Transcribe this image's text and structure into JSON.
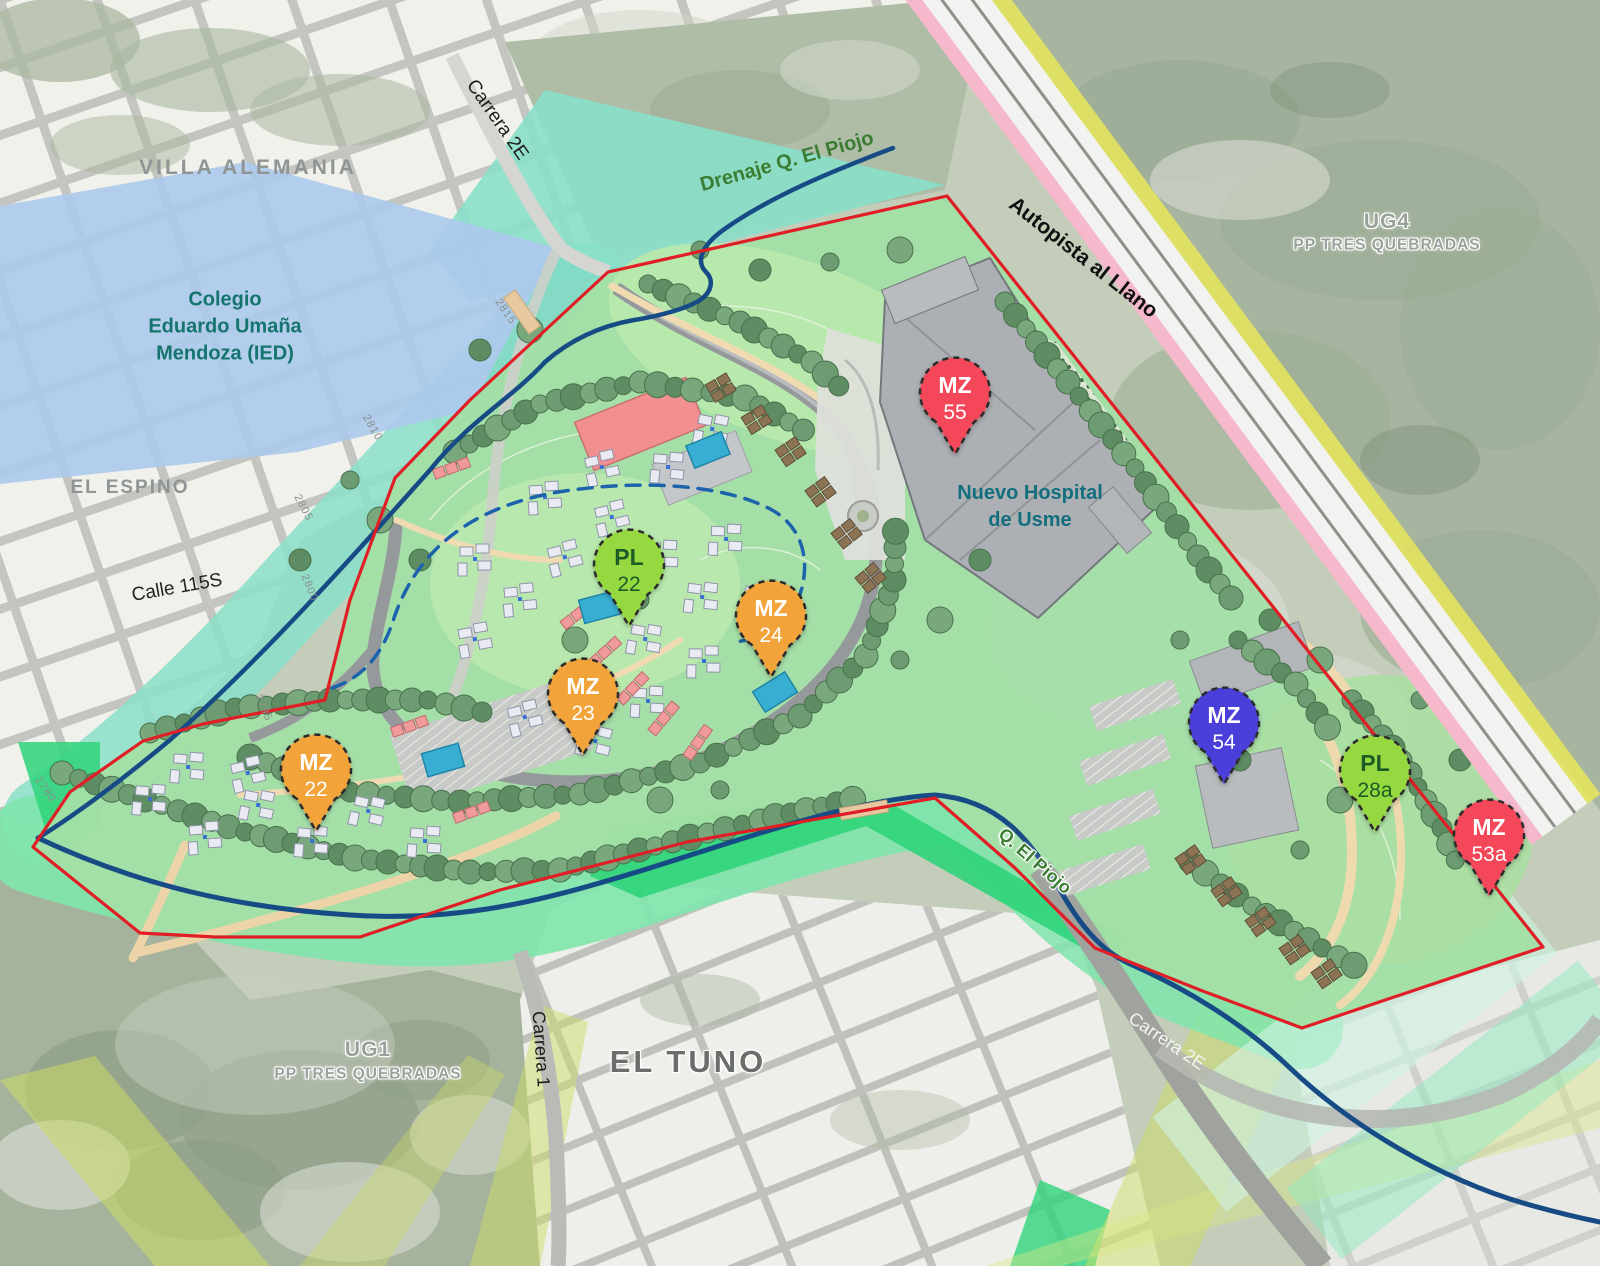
{
  "map": {
    "description": "Urban development site plan, Usme sector",
    "colors": {
      "site_boundary_red": "#E01E25",
      "stream_blue": "#164B85",
      "dashed_drain_blue": "#1C63AC",
      "drainage_overlay_teal": "#8ADFC9",
      "school_overlay_blue": "#ACC9EC",
      "corridor_green": "#7FE5AC",
      "bright_green": "#2FD47A",
      "highway_yellow_stripe": "#E8E85A",
      "highway_pink_stripe": "#F5B9CB",
      "pin_red": "#F4485A",
      "pin_orange": "#F2A43A",
      "pin_green": "#96D83F",
      "pin_indigo": "#4A3FD9"
    },
    "labels": [
      {
        "id": "villa-alemania",
        "text": "VILLA  ALEMANIA",
        "x": 248,
        "y": 168,
        "rot": 0,
        "size": 21,
        "color": "#8E9594",
        "weight": 700,
        "spacing": "3px",
        "halo": false
      },
      {
        "id": "colegio-eduardo-umana",
        "text": "Colegio\nEduardo  Umaña\nMendoza (IED)",
        "x": 225,
        "y": 327,
        "rot": 0,
        "size": 20,
        "color": "#15756E",
        "weight": 700,
        "spacing": "0px",
        "halo": false
      },
      {
        "id": "el-espino",
        "text": "EL ESPINO",
        "x": 130,
        "y": 488,
        "rot": 0,
        "size": 19,
        "color": "#8E9594",
        "weight": 700,
        "spacing": "2px",
        "halo": false
      },
      {
        "id": "calle-115s",
        "text": "Calle 115S",
        "x": 177,
        "y": 588,
        "rot": -10,
        "size": 19,
        "color": "#222222",
        "weight": 400,
        "spacing": "0px",
        "halo": false
      },
      {
        "id": "carrera-2e-top",
        "text": "Carrera 2E",
        "x": 497,
        "y": 120,
        "rot": 55,
        "size": 19,
        "color": "#1b1b1b",
        "weight": 400,
        "spacing": "0px",
        "halo": false
      },
      {
        "id": "drenaje-q-el-piojo",
        "text": "Drenaje Q. El Piojo",
        "x": 787,
        "y": 162,
        "rot": -15.5,
        "size": 20,
        "color": "#3A7D33",
        "weight": 700,
        "spacing": "0px",
        "halo": false
      },
      {
        "id": "autopista-al-llano",
        "text": "Autopista al Llano",
        "x": 1083,
        "y": 258,
        "rot": 38,
        "size": 21,
        "color": "#101010",
        "weight": 700,
        "spacing": "0px",
        "halo": false
      },
      {
        "id": "ug4",
        "text": "UG4",
        "x": 1387,
        "y": 222,
        "rot": 0,
        "size": 21,
        "color": "#98A29A",
        "weight": 700,
        "spacing": "1px",
        "halo": true
      },
      {
        "id": "ug4-pp-tres-quebradas",
        "text": "PP TRES QUEBRADAS",
        "x": 1387,
        "y": 246,
        "rot": 0,
        "size": 15.5,
        "color": "#98A29A",
        "weight": 700,
        "spacing": "1px",
        "halo": true
      },
      {
        "id": "nuevo-hospital-de-usme",
        "text": "Nuevo Hospital\nde Usme",
        "x": 1030,
        "y": 507,
        "rot": 0,
        "size": 20,
        "color": "#136F7E",
        "weight": 700,
        "spacing": "0px",
        "halo": false
      },
      {
        "id": "q-el-piojo",
        "text": "Q. El Piojo",
        "x": 1035,
        "y": 861,
        "rot": 41,
        "size": 18,
        "color": "#3A7D33",
        "weight": 700,
        "spacing": "0px",
        "halo": true
      },
      {
        "id": "carrera-2e-bottom",
        "text": "Carrera 2E",
        "x": 1167,
        "y": 1041,
        "rot": 34,
        "size": 18,
        "color": "#F4F4F2",
        "weight": 400,
        "spacing": "0px",
        "halo": false
      },
      {
        "id": "carrera-1",
        "text": "Carrera 1",
        "x": 541,
        "y": 1049,
        "rot": 86,
        "size": 18,
        "color": "#1b1b1b",
        "weight": 400,
        "spacing": "0px",
        "halo": false
      },
      {
        "id": "ug1",
        "text": "UG1",
        "x": 368,
        "y": 1050,
        "rot": 0,
        "size": 21,
        "color": "#98A29A",
        "weight": 700,
        "spacing": "1px",
        "halo": true
      },
      {
        "id": "ug1-pp-tres-quebradas",
        "text": "PP TRES QUEBRADAS",
        "x": 368,
        "y": 1075,
        "rot": 0,
        "size": 15.5,
        "color": "#98A29A",
        "weight": 700,
        "spacing": "1px",
        "halo": true
      },
      {
        "id": "el-tuno",
        "text": "EL TUNO",
        "x": 688,
        "y": 1062,
        "rot": 0,
        "size": 31,
        "color": "#6A6E6A",
        "weight": 700,
        "spacing": "3px",
        "halo": true
      },
      {
        "id": "contour-2815",
        "text": "2815",
        "x": 505,
        "y": 312,
        "rot": 56,
        "size": 11,
        "color": "#8A8F8C",
        "weight": 400,
        "spacing": "1px",
        "halo": false
      },
      {
        "id": "contour-2810",
        "text": "2810",
        "x": 372,
        "y": 428,
        "rot": 60,
        "size": 11,
        "color": "#8A8F8C",
        "weight": 400,
        "spacing": "1px",
        "halo": false
      },
      {
        "id": "contour-2805",
        "text": "2805",
        "x": 303,
        "y": 508,
        "rot": 62,
        "size": 11,
        "color": "#8A8F8C",
        "weight": 400,
        "spacing": "1px",
        "halo": false
      },
      {
        "id": "contour-2800",
        "text": "2800",
        "x": 309,
        "y": 588,
        "rot": 68,
        "size": 11,
        "color": "#8A8F8C",
        "weight": 400,
        "spacing": "1px",
        "halo": false
      },
      {
        "id": "contour-2795",
        "text": "2795",
        "x": 263,
        "y": 708,
        "rot": 66,
        "size": 11,
        "color": "#8A8F8C",
        "weight": 400,
        "spacing": "1px",
        "halo": false
      },
      {
        "id": "contour-2780",
        "text": "2780",
        "x": 45,
        "y": 790,
        "rot": 55,
        "size": 11,
        "color": "#8A8F8C",
        "weight": 400,
        "spacing": "1px",
        "halo": false
      }
    ],
    "pins": [
      {
        "id": "mz-55",
        "kind": "MZ",
        "code": "55",
        "x": 955,
        "y": 399,
        "fill": "#F4485A",
        "text_color": "#FFFFFF"
      },
      {
        "id": "pl-22",
        "kind": "PL",
        "code": "22",
        "x": 629,
        "y": 571,
        "fill": "#96D83F",
        "text_color": "#1D5B26"
      },
      {
        "id": "mz-24",
        "kind": "MZ",
        "code": "24",
        "x": 771,
        "y": 622,
        "fill": "#F2A43A",
        "text_color": "#FFFFFF"
      },
      {
        "id": "mz-23",
        "kind": "MZ",
        "code": "23",
        "x": 583,
        "y": 700,
        "fill": "#F2A43A",
        "text_color": "#FFFFFF"
      },
      {
        "id": "mz-22",
        "kind": "MZ",
        "code": "22",
        "x": 316,
        "y": 776,
        "fill": "#F2A43A",
        "text_color": "#FFFFFF"
      },
      {
        "id": "mz-54",
        "kind": "MZ",
        "code": "54",
        "x": 1224,
        "y": 729,
        "fill": "#4A3FD9",
        "text_color": "#FFFFFF"
      },
      {
        "id": "pl-28a",
        "kind": "PL",
        "code": "28a",
        "x": 1375,
        "y": 777,
        "fill": "#96D83F",
        "text_color": "#1D5B26"
      },
      {
        "id": "mz-53a",
        "kind": "MZ",
        "code": "53a",
        "x": 1489,
        "y": 841,
        "fill": "#F4485A",
        "text_color": "#FFFFFF"
      }
    ]
  }
}
